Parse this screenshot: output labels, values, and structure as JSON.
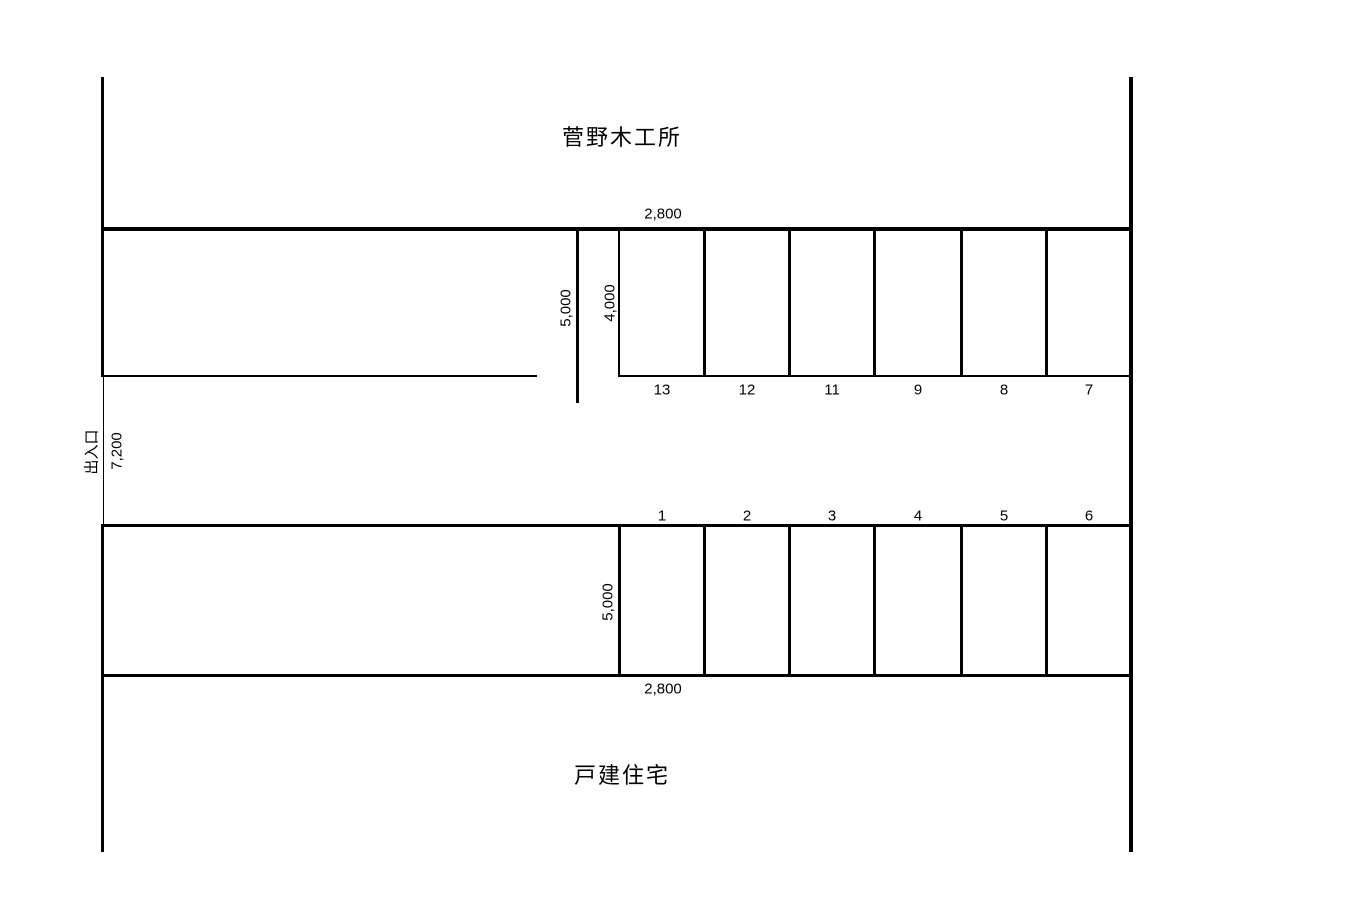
{
  "page": {
    "background": "#ffffff",
    "line_color": "#000000",
    "text_color": "#000000"
  },
  "labels": {
    "top_building": "菅野木工所",
    "bottom_building": "戸建住宅",
    "entrance": "出入口"
  },
  "dimensions": {
    "top_space_width": "2,800",
    "upper_left_depth": "5,000",
    "upper_row_depth": "4,000",
    "entrance_width": "7,200",
    "lower_row_depth": "5,000",
    "bottom_space_width": "2,800"
  },
  "spaces": {
    "top_row": [
      "13",
      "12",
      "11",
      "9",
      "8",
      "7"
    ],
    "bottom_row": [
      "1",
      "2",
      "3",
      "4",
      "5",
      "6"
    ]
  }
}
